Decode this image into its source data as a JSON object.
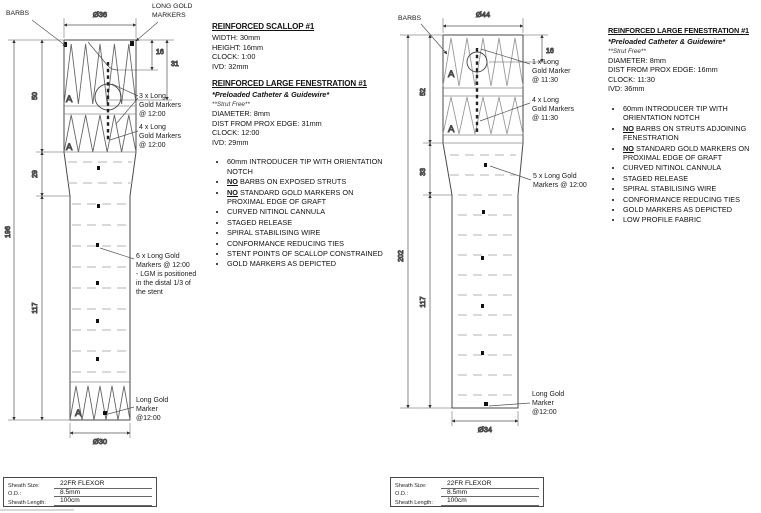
{
  "colors": {
    "background": "#ffffff",
    "ink": "#1a1a1a",
    "line": "#4a4a4a",
    "light_dash": "#b3b3b3"
  },
  "common": {
    "strut_label": "A"
  },
  "left_diagram": {
    "labels": {
      "barbs": "BARBS",
      "long_gold_markers": "LONG GOLD\nMARKERS"
    },
    "dims": {
      "top_diameter": "Ø36",
      "scallop_height": "16",
      "scallop_ivd": "31",
      "seg_proximal": "50",
      "seg_taper": "29",
      "overall": "196",
      "seg_distal": "117",
      "bottom_diameter": "Ø30"
    },
    "annotations": {
      "markers_3x": "3 x Long\nGold Markers\n@ 12:00",
      "markers_4x": "4 x Long\nGold Markers\n@ 12:00",
      "markers_6x": "6 x Long Gold\nMarkers @ 12:00\n- LGM is positioned\nin the distal 1/3 of\nthe stent",
      "marker_distal": "Long Gold\nMarker\n@12:00"
    }
  },
  "right_diagram": {
    "labels": {
      "barbs": "BARBS"
    },
    "dims": {
      "top_diameter": "Ø44",
      "fen_height": "16",
      "seg_proximal": "52",
      "seg_taper": "33",
      "overall": "202",
      "seg_distal": "117",
      "bottom_diameter": "Ø34"
    },
    "annotations": {
      "markers_1x": "1 x Long\nGold Marker\n@ 11:30",
      "markers_4x": "4 x Long\nGold Markers\n@ 11:30",
      "markers_5x": "5 x Long Gold\nMarkers @ 12:00",
      "marker_distal": "Long Gold\nMarker\n@12:00"
    }
  },
  "left_specs": {
    "title1": "REINFORCED SCALLOP #1",
    "scallop_lines": [
      "WIDTH: 30mm",
      "HEIGHT: 16mm",
      "CLOCK: 1:00",
      "IVD: 32mm"
    ],
    "title2": "REINFORCED LARGE FENESTRATION #1",
    "sub1": "*Preloaded Catheter & Guidewire*",
    "sub2": "**Strut Free**",
    "fen_lines": [
      "DIAMETER: 8mm",
      "DIST FROM PROX EDGE: 31mm",
      "CLOCK: 12:00",
      "IVD: 29mm"
    ],
    "bullets": [
      {
        "b": "",
        "t": "60mm INTRODUCER TIP WITH ORIENTATION NOTCH"
      },
      {
        "b": "NO",
        "t": " BARBS ON EXPOSED STRUTS"
      },
      {
        "b": "NO",
        "t": " STANDARD GOLD MARKERS ON PROXIMAL EDGE OF GRAFT"
      },
      {
        "b": "",
        "t": "CURVED NITINOL CANNULA"
      },
      {
        "b": "",
        "t": "STAGED RELEASE"
      },
      {
        "b": "",
        "t": "SPIRAL STABILISING WIRE"
      },
      {
        "b": "",
        "t": "CONFORMANCE REDUCING TIES"
      },
      {
        "b": "",
        "t": "STENT POINTS OF SCALLOP CONSTRAINED"
      },
      {
        "b": "",
        "t": "GOLD MARKERS AS DEPICTED"
      }
    ]
  },
  "right_specs": {
    "title": "REINFORCED LARGE FENESTRATION #1",
    "sub1": "*Preloaded Catheter & Guidewire*",
    "sub2": "**Strut Free**",
    "fen_lines": [
      "DIAMETER: 8mm",
      "DIST FROM PROX EDGE: 16mm",
      "CLOCK: 11:30",
      "IVD: 36mm"
    ],
    "bullets": [
      {
        "b": "",
        "t": "60mm INTRODUCER TIP WITH ORIENTATION NOTCH"
      },
      {
        "b": "NO",
        "t": " BARBS ON STRUTS ADJOINING FENESTRATION"
      },
      {
        "b": "NO",
        "t": " STANDARD GOLD MARKERS ON PROXIMAL EDGE OF GRAFT"
      },
      {
        "b": "",
        "t": "CURVED NITINOL CANNULA"
      },
      {
        "b": "",
        "t": "STAGED RELEASE"
      },
      {
        "b": "",
        "t": "SPIRAL STABILISING WIRE"
      },
      {
        "b": "",
        "t": "CONFORMANCE REDUCING TIES"
      },
      {
        "b": "",
        "t": "GOLD MARKERS AS DEPICTED"
      },
      {
        "b": "",
        "t": "LOW PROFILE FABRIC"
      }
    ]
  },
  "sheath_table": {
    "rows": [
      {
        "label": "Sheath Size:",
        "value": "22FR FLEXOR"
      },
      {
        "label": "O.D.:",
        "value": "8.5mm"
      },
      {
        "label": "Sheath Length:",
        "value": "100cm"
      }
    ]
  }
}
